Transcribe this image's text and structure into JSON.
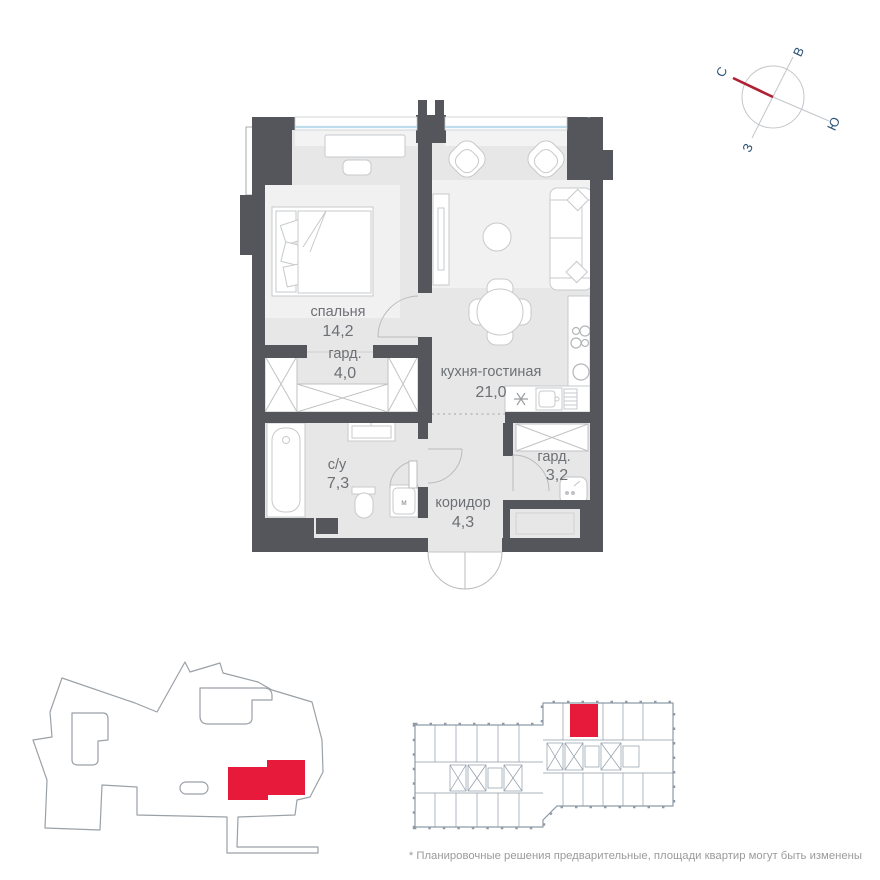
{
  "plan": {
    "rooms": [
      {
        "id": "bedroom",
        "name": "спальня",
        "area": "14,2"
      },
      {
        "id": "wardrobe1",
        "name": "гард.",
        "area": "4,0"
      },
      {
        "id": "kitchen_living",
        "name": "кухня-гостиная",
        "area": "21,0"
      },
      {
        "id": "bathroom",
        "name": "с/у",
        "area": "7,3"
      },
      {
        "id": "wardrobe2",
        "name": "гард.",
        "area": "3,2"
      },
      {
        "id": "corridor",
        "name": "коридор",
        "area": "4,3"
      }
    ],
    "labels": {
      "washing_machine": "м"
    }
  },
  "compass": {
    "north": "С",
    "east": "В",
    "south": "Ю",
    "west": "З"
  },
  "footer": {
    "disclaimer": "* Планировочные решения предварительные, площади квартир могут быть изменены"
  },
  "colors": {
    "wall": "#54565c",
    "floor": "#e7e7e8",
    "floor_light": "#f1f1f2",
    "accent_red": "#e81a3b",
    "compass_north_red": "#b11f32",
    "window_glass": "#bfdcec",
    "site_outline": "#9aa1a7",
    "plate_line": "#8e9aa8",
    "label_text": "#6d7074",
    "disclaimer_text": "#9b9b9b"
  }
}
